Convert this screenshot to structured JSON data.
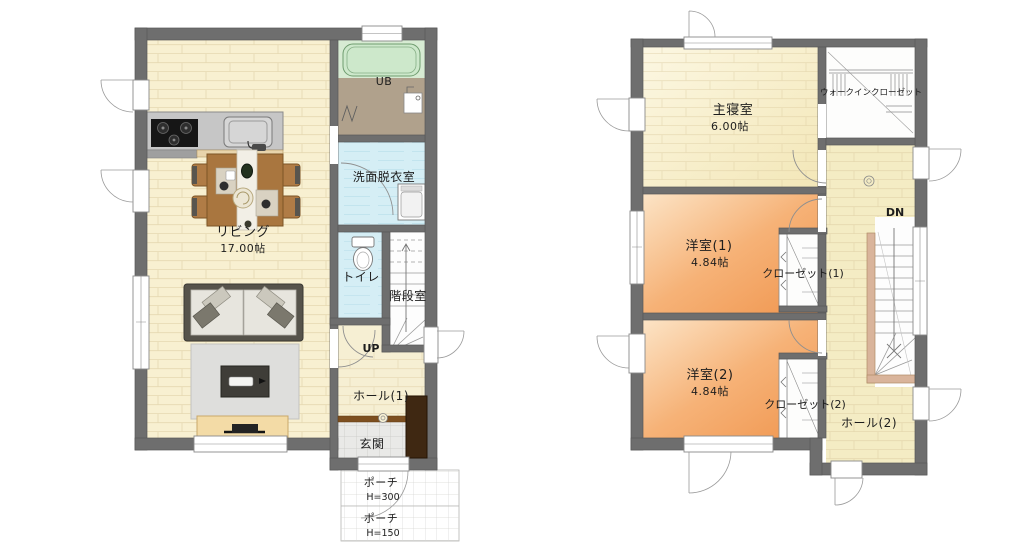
{
  "floor1": {
    "rooms": {
      "living": {
        "label": "リビング",
        "size": "17.00帖"
      },
      "unit_bath": {
        "label": "UB"
      },
      "washroom": {
        "label": "洗面脱衣室"
      },
      "toilet": {
        "label": "トイレ"
      },
      "stair_room": {
        "label": "階段室"
      },
      "hall": {
        "label": "ホール(1)"
      },
      "entrance": {
        "label": "玄関"
      },
      "porch_upper": {
        "label": "ポーチ",
        "height_note": "H=300"
      },
      "porch_lower": {
        "label": "ポーチ",
        "height_note": "H=150"
      }
    },
    "stairs": {
      "direction": "UP"
    }
  },
  "floor2": {
    "rooms": {
      "master_bedroom": {
        "label": "主寝室",
        "size": "6.00帖"
      },
      "walk_in_closet": {
        "label": "ウォークインクローゼット"
      },
      "western_room_1": {
        "label": "洋室(1)",
        "size": "4.84帖"
      },
      "closet_1": {
        "label": "クローゼット(1)"
      },
      "western_room_2": {
        "label": "洋室(2)",
        "size": "4.84帖"
      },
      "closet_2": {
        "label": "クローゼット(2)"
      },
      "hall": {
        "label": "ホール(2)"
      }
    },
    "stairs": {
      "direction": "DN"
    }
  },
  "colors": {
    "wall": "#6e6e6e",
    "living_floor": "#f8f0d1",
    "bedroom_floor": "#f9f2d8",
    "western_room_floor": "#f2a469",
    "hall_floor": "#f4ecc4",
    "wet_room_floor": "#d5eef5",
    "bath_floor": "#b0a18c",
    "bathtub": "#cfe9cd",
    "entrance_tile": "#e9e9e7",
    "furniture_wood": "#a9763f",
    "shoe_cabinet": "#3f2812",
    "stair_handrail": "#d9b49b"
  }
}
